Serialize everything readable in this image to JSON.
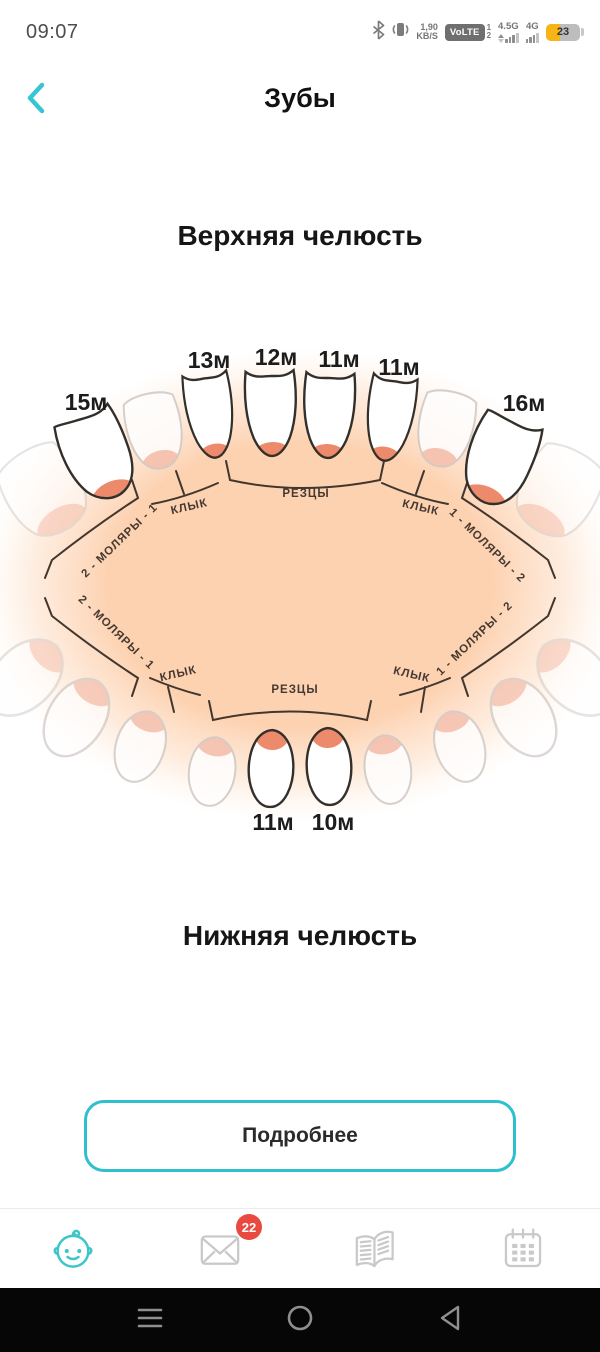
{
  "status_bar": {
    "time": "09:07",
    "network_speed_line1": "1,90",
    "network_speed_line2": "KB/S",
    "volte": "VoLTE",
    "sim1": "1",
    "sim2": "2",
    "net1": "4.5G",
    "net2": "4G",
    "battery_percent": "23"
  },
  "header": {
    "title": "Зубы"
  },
  "sections": {
    "upper_heading": "Верхняя челюсть",
    "lower_heading": "Нижняя челюсть"
  },
  "diagram": {
    "upper": {
      "labels": {
        "molar_left": "15м",
        "lateral_left": "13м",
        "central_left": "12м",
        "central_right": "11м",
        "lateral_right": "11м",
        "molar_right": "16м"
      },
      "groups": {
        "molars_left": "2 - МОЛЯРЫ - 1",
        "canine_left": "КЛЫК",
        "incisors": "РЕЗЦЫ",
        "canine_right": "КЛЫК",
        "molars_right": "1 - МОЛЯРЫ - 2"
      }
    },
    "lower": {
      "labels": {
        "central_left": "11м",
        "central_right": "10м"
      },
      "groups": {
        "molars_left": "2 - МОЛЯРЫ - 1",
        "canine_left": "КЛЫК",
        "incisors": "РЕЗЦЫ",
        "canine_right": "КЛЫК",
        "molars_right": "1 - МОЛЯРЫ - 2"
      }
    }
  },
  "button": {
    "label": "Подробнее"
  },
  "tab_bar": {
    "badge": "22"
  },
  "colors": {
    "accent": "#35c4d0",
    "peach": "#fdd2b1",
    "gum": "#ed8a6c",
    "faded_gum": "#f5bfae",
    "badge": "#e84a3f",
    "battery_yellow": "#f7b414"
  }
}
